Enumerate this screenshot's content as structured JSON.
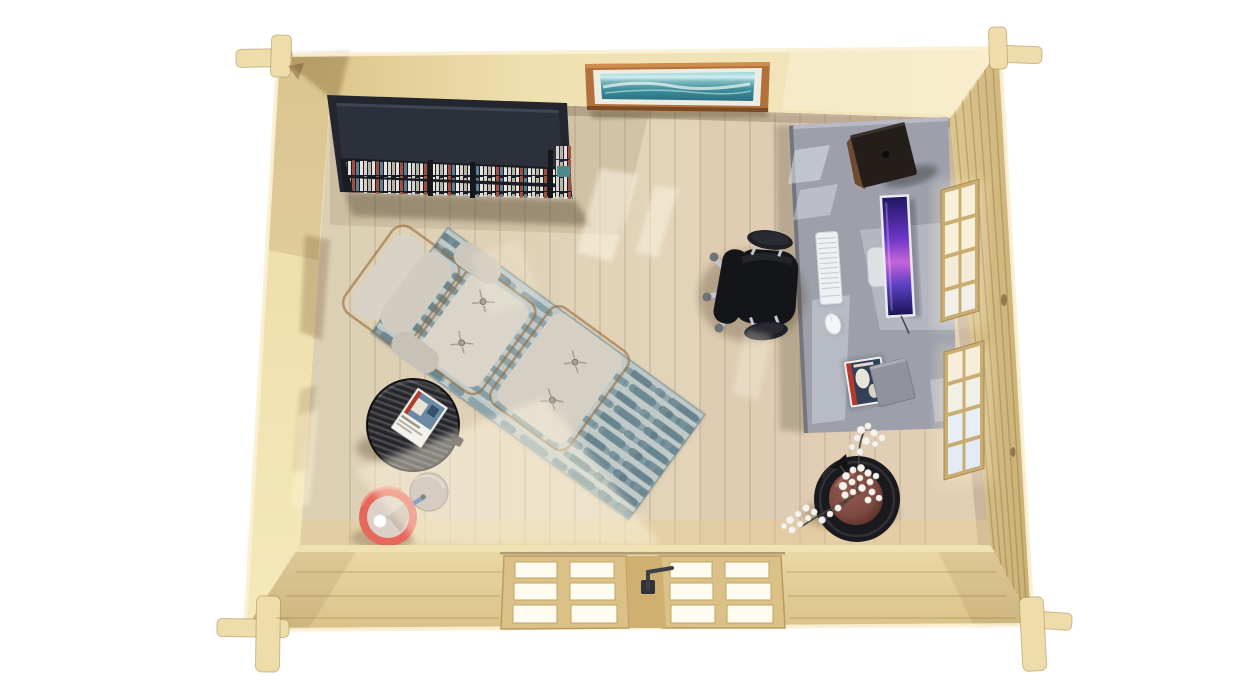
{
  "scene": {
    "kind": "3d-render-top-view",
    "subject": "log cabin garden office interior viewed from directly above",
    "background": "#ffffff"
  },
  "objects": [
    {
      "id": "cabin-walls",
      "label": "interlocking pine log walls with crossed corner joints"
    },
    {
      "id": "wood-floor",
      "label": "whitewashed pine plank floor"
    },
    {
      "id": "bookshelf",
      "label": "dark bookshelf with rows of books, top-left corner"
    },
    {
      "id": "seascape-picture",
      "label": "framed seascape painting on top wall"
    },
    {
      "id": "desk",
      "label": "grey office desk along right wall"
    },
    {
      "id": "speaker",
      "label": "dark speaker box on desk"
    },
    {
      "id": "monitor",
      "label": "computer display with purple wallpaper"
    },
    {
      "id": "keyboard",
      "label": "white keyboard"
    },
    {
      "id": "mouse",
      "label": "white mouse"
    },
    {
      "id": "desk-magazines",
      "label": "magazine stack and grey laptop on desk"
    },
    {
      "id": "office-chair",
      "label": "black swivel office chair with chrome base"
    },
    {
      "id": "lounge-chair",
      "label": "cream recliner lounge chair with tufted seat"
    },
    {
      "id": "ottoman",
      "label": "matching tufted ottoman"
    },
    {
      "id": "rug",
      "label": "blue-grey striped rug laid diagonally"
    },
    {
      "id": "side-table",
      "label": "round dark wood side table with magazine"
    },
    {
      "id": "floor-lamp",
      "label": "red drum floor lamp seen from above with round base"
    },
    {
      "id": "plant",
      "label": "white blossom branches in round dark pot"
    },
    {
      "id": "windows",
      "label": "two multi-pane windows in right wall"
    },
    {
      "id": "glazed-doors",
      "label": "double glazed doors in bottom wall with handle"
    }
  ],
  "colors": {
    "background": "#ffffff",
    "wall_top_a": "#d9c084",
    "wall_top_b": "#f2e4ba",
    "wall_left": "#f0e2b0",
    "wall_right_a": "#dcc68e",
    "wall_right_b": "#c9af74",
    "wall_bottom_a": "#ecd9a6",
    "wall_bottom_b": "#d9c189",
    "edge_highlight": "#f9f1d4",
    "log_end": "#eeddab",
    "floor_a": "#dbcfb4",
    "floor_b": "#e9d8bd",
    "plank_line": "#8a7a5c",
    "rug_base": "#bfc9c8",
    "rug_dash": "#7f9aa2",
    "rug_dash_dark": "#5d7a85",
    "rug_band": "#d5dad2",
    "cushion": "#d9d3c7",
    "cushion_shade": "#c2bcb0",
    "wood_trim": "#9a6a3a",
    "button": "#a8a296",
    "table_top": "#2e2e33",
    "lamp_shade": "#e6675c",
    "lamp_inner": "#dcd1c8",
    "lamp_bulb": "#ffffff",
    "lamp_base": "#b7abaa",
    "lamp_arm": "#2d59c4",
    "pot_outer": "#1a1a1e",
    "pot_inner": "#7c4a42",
    "blossom": "#f6f3ee",
    "branch": "#4a443c",
    "desk_top": "#9da0ab",
    "desk_lit": "#dfe3ea",
    "monitor_frame": "#e9eaee",
    "monitor_stand": "#dfe0e4",
    "keyboard": "#eef0f3",
    "mouse": "#f5f6f8",
    "laptop": "#90939c",
    "speaker_body": "#241e1b",
    "speaker_side": "#6e4a30",
    "chair_body": "#141519",
    "chair_pad": "#1f2026",
    "chair_chrome": "#c3c6cc",
    "shelf_body": "#23262e",
    "shelf_panel": "#2b303a",
    "shelf_face": "#191c22",
    "frame_wood": "#b2703a",
    "frame_mat": "#edece3",
    "window_frame": "#c9ad72",
    "pane_warm": "#f8f1da",
    "pane_cool": "#e9eff7",
    "door_wood": "#dbc187",
    "door_pane": "#fdfaef",
    "door_stile": "#cfb070",
    "door_handle": "#3c3f45"
  }
}
